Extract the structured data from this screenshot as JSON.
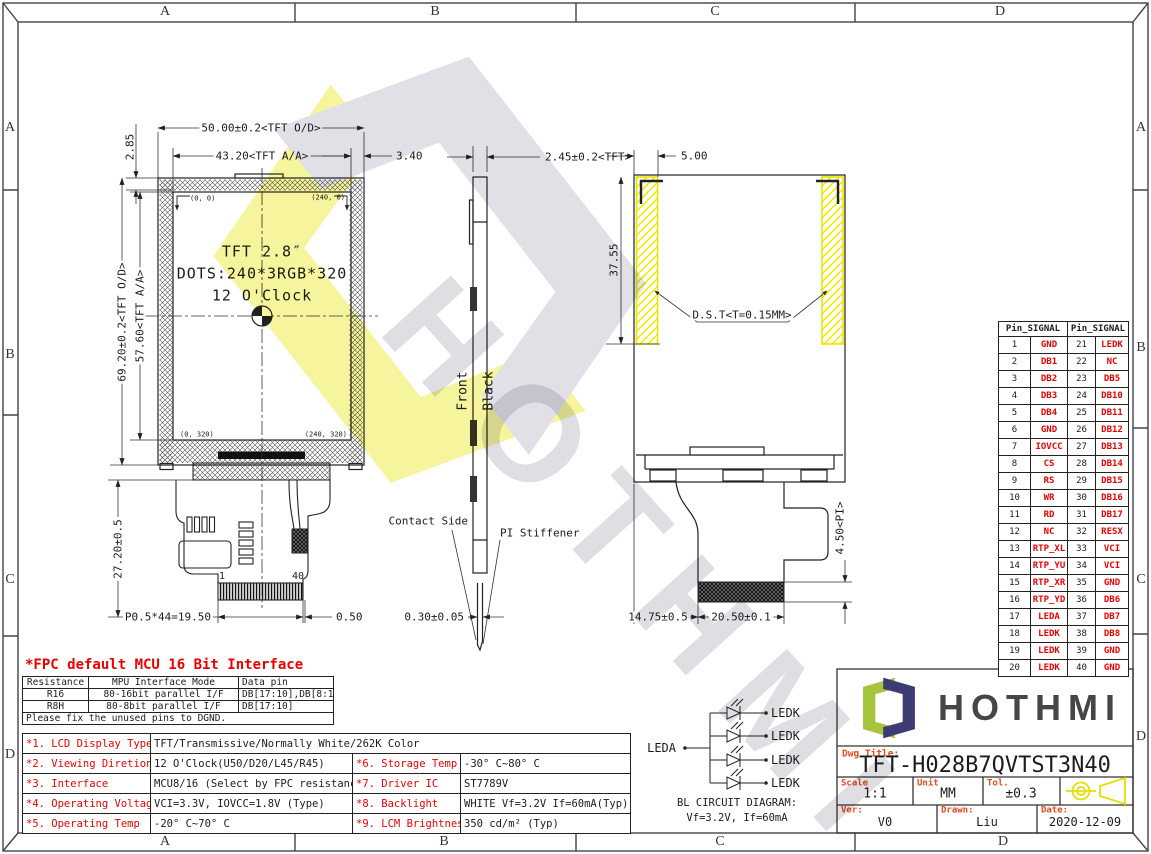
{
  "zones": {
    "top": [
      "A",
      "B",
      "C",
      "D"
    ],
    "bottom": [
      "A",
      "B",
      "C",
      "D"
    ],
    "left": [
      "A",
      "B",
      "C",
      "D"
    ],
    "right": [
      "A",
      "B",
      "C",
      "D"
    ]
  },
  "front": {
    "line1": "TFT 2.8″",
    "line2": "DOTS:240*3RGB*320",
    "line3": "12 O'Clock",
    "c00": "(0, 0)",
    "c2400": "(240, 0)",
    "c0320": "(0, 320)",
    "c240320": "(240, 320)",
    "pin_first": "1",
    "pin_last": "40",
    "d_od_w": "50.00±0.2<TFT O/D>",
    "d_aa_w": "43.20<TFT A/A>",
    "d_gap_r": "3.40",
    "d_gap_t": "2.85",
    "d_aa_h": "57.60<TFT A/A>",
    "d_od_h": "69.20±0.2<TFT O/D>",
    "d_tail": "27.20±0.5",
    "d_pitch": "P0.5*44=19.50",
    "d_margin": "0.50"
  },
  "side": {
    "front_label": "Front",
    "back_label": "Black",
    "contact": "Contact Side",
    "stiffener": "PI Stiffener",
    "d_thick": "2.45±0.2<TFT>",
    "d_fpc": "0.30±0.05"
  },
  "back": {
    "d_tape_w": "5.00",
    "d_tape_h": "37.55",
    "tape": "D.S.T<T=0.15MM>",
    "d_pi": "4.50<PI>",
    "d_tail_w": "20.50±0.1",
    "d_tail_off": "14.75±0.5"
  },
  "pins": {
    "h1": "Pin_SIGNAL",
    "h2": "Pin_SIGNAL",
    "rows": [
      [
        "1",
        "GND",
        "21",
        "LEDK"
      ],
      [
        "2",
        "DB1",
        "22",
        "NC"
      ],
      [
        "3",
        "DB2",
        "23",
        "DB5"
      ],
      [
        "4",
        "DB3",
        "24",
        "DB10"
      ],
      [
        "5",
        "DB4",
        "25",
        "DB11"
      ],
      [
        "6",
        "GND",
        "26",
        "DB12"
      ],
      [
        "7",
        "IOVCC",
        "27",
        "DB13"
      ],
      [
        "8",
        "CS",
        "28",
        "DB14"
      ],
      [
        "9",
        "RS",
        "29",
        "DB15"
      ],
      [
        "10",
        "WR",
        "30",
        "DB16"
      ],
      [
        "11",
        "RD",
        "31",
        "DB17"
      ],
      [
        "12",
        "NC",
        "32",
        "RESX"
      ],
      [
        "13",
        "RTP_XL",
        "33",
        "VCI"
      ],
      [
        "14",
        "RTP_YU",
        "34",
        "VCI"
      ],
      [
        "15",
        "RTP_XR",
        "35",
        "GND"
      ],
      [
        "16",
        "RTP_YD",
        "36",
        "DB6"
      ],
      [
        "17",
        "LEDA",
        "37",
        "DB7"
      ],
      [
        "18",
        "LEDK",
        "38",
        "DB8"
      ],
      [
        "19",
        "LEDK",
        "39",
        "GND"
      ],
      [
        "20",
        "LEDK",
        "40",
        "GND"
      ]
    ]
  },
  "fpc": {
    "title": "*FPC default MCU 16 Bit Interface",
    "headers": [
      "Resistance",
      "MPU Interface Mode",
      "Data pin"
    ],
    "rows": [
      [
        "R16",
        "80-16bit parallel I/F",
        "DB[17:10],DB[8:1]"
      ],
      [
        "R8H",
        "80-8bit parallel I/F",
        "DB[17:10]"
      ]
    ],
    "footer": "Please fix the unused pins to DGND."
  },
  "spec": {
    "row1": [
      "*1. LCD Display Type",
      "TFT/Transmissive/Normally White/262K Color"
    ],
    "rows": [
      [
        "*2. Viewing Diretion",
        "12 O'Clock(U50/D20/L45/R45)",
        "*6. Storage Temp",
        "-30° C~80° C"
      ],
      [
        "*3. Interface",
        "MCU8/16 (Select by FPC resistance)",
        "*7. Driver IC",
        "ST7789V"
      ],
      [
        "*4. Operating Voltage",
        "VCI=3.3V, IOVCC=1.8V (Type)",
        "*8. Backlight",
        "WHITE Vf=3.2V If=60mA(Typ)"
      ],
      [
        "*5. Operating Temp",
        "-20° C~70° C",
        "*9. LCM Brightness",
        "350 cd/m² (Typ)"
      ]
    ]
  },
  "bl": {
    "anode": "LEDA",
    "cathodes": [
      "LEDK",
      "LEDK",
      "LEDK",
      "LEDK"
    ],
    "caption1": "BL CIRCUIT DIAGRAM:",
    "caption2": "Vf=3.2V, If=60mA"
  },
  "tb": {
    "brand": "HOTHMI",
    "dwg_label": "Dwg Title:",
    "title": "TFT-H028B7QVTST3N40",
    "scale_label": "Scale",
    "scale": "1:1",
    "unit_label": "Unit",
    "unit": "MM",
    "tol_label": "Tol.",
    "tol": "±0.3",
    "ver_label": "Ver:",
    "ver": "V0",
    "drawn_label": "Drawn:",
    "drawn": "Liu",
    "date_label": "Date:",
    "date": "2020-12-09"
  },
  "wm": {
    "brand": "HOTHMI"
  },
  "colors": {
    "red": "#ee0000",
    "hatch_yellow": "#f0ed00",
    "logo_green": "#a6c43c",
    "logo_navy": "#3c3c72",
    "brand_gray": "#46464a"
  }
}
